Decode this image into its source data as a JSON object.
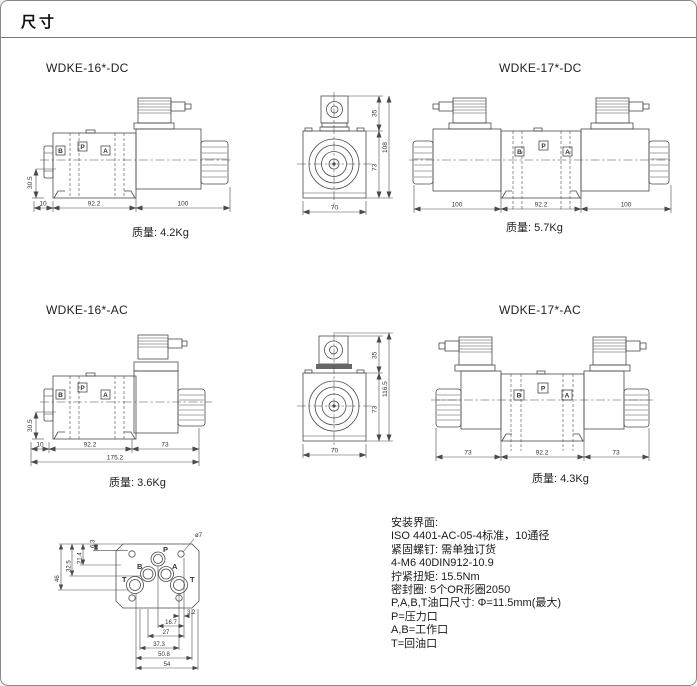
{
  "page": {
    "title": "尺寸"
  },
  "valves": {
    "dc16": {
      "label": "WDKE-16*-DC",
      "weight": "质量: 4.2Kg",
      "ports": {
        "b": "B",
        "p": "P",
        "a": "A"
      },
      "dims": {
        "height": "30.5",
        "seg1": "10",
        "seg2": "92.2",
        "seg3": "100"
      }
    },
    "dc17": {
      "label": "WDKE-17*-DC",
      "weight": "质量: 5.7Kg",
      "ports": {
        "b": "B",
        "p": "P",
        "a": "A"
      },
      "dims": {
        "conn": "35",
        "body": "73",
        "total": "108",
        "width": "70",
        "seg1": "100",
        "seg2": "92.2",
        "seg3": "100"
      }
    },
    "ac16": {
      "label": "WDKE-16*-AC",
      "weight": "质量: 3.6Kg",
      "ports": {
        "b": "B",
        "p": "P",
        "a": "A"
      },
      "dims": {
        "height": "30.5",
        "seg1": "10",
        "seg2": "92.2",
        "seg3": "73",
        "total": "175.2"
      }
    },
    "ac17": {
      "label": "WDKE-17*-AC",
      "weight": "质量: 4.3Kg",
      "ports": {
        "b": "B",
        "p": "P",
        "a": "A"
      },
      "dims": {
        "conn": "35",
        "body": "73",
        "total": "116.5",
        "width": "70",
        "seg1": "73",
        "seg2": "92.2",
        "seg3": "73"
      }
    }
  },
  "interface": {
    "ports": {
      "p": "P",
      "b": "B",
      "a": "A",
      "t1": "T",
      "t2": "T"
    },
    "hole_label": "ø7",
    "dims": {
      "v_top": "6.3",
      "v_inner": "21.4",
      "v_mid": "32.5",
      "v_total": "46",
      "b1": "3.2",
      "b2": "16.7",
      "b3": "27",
      "b4": "37.3",
      "b5": "50.8",
      "b6": "54"
    }
  },
  "notes": {
    "lines": [
      "安装界面:",
      "ISO 4401-AC-05-4标准，10通径",
      "紧固螺钉: 需单独订货",
      "4-M6 40DIN912-10.9",
      "拧紧扭矩: 15.5Nm",
      "密封圈: 5个OR形圈2050",
      "P,A,B,T油口尺寸: Φ=11.5mm(最大)",
      "P=压力口",
      "A,B=工作口",
      "T=回油口"
    ]
  },
  "colors": {
    "line": "#4a4a4a",
    "text": "#1a1a1a",
    "background": "#ffffff"
  }
}
